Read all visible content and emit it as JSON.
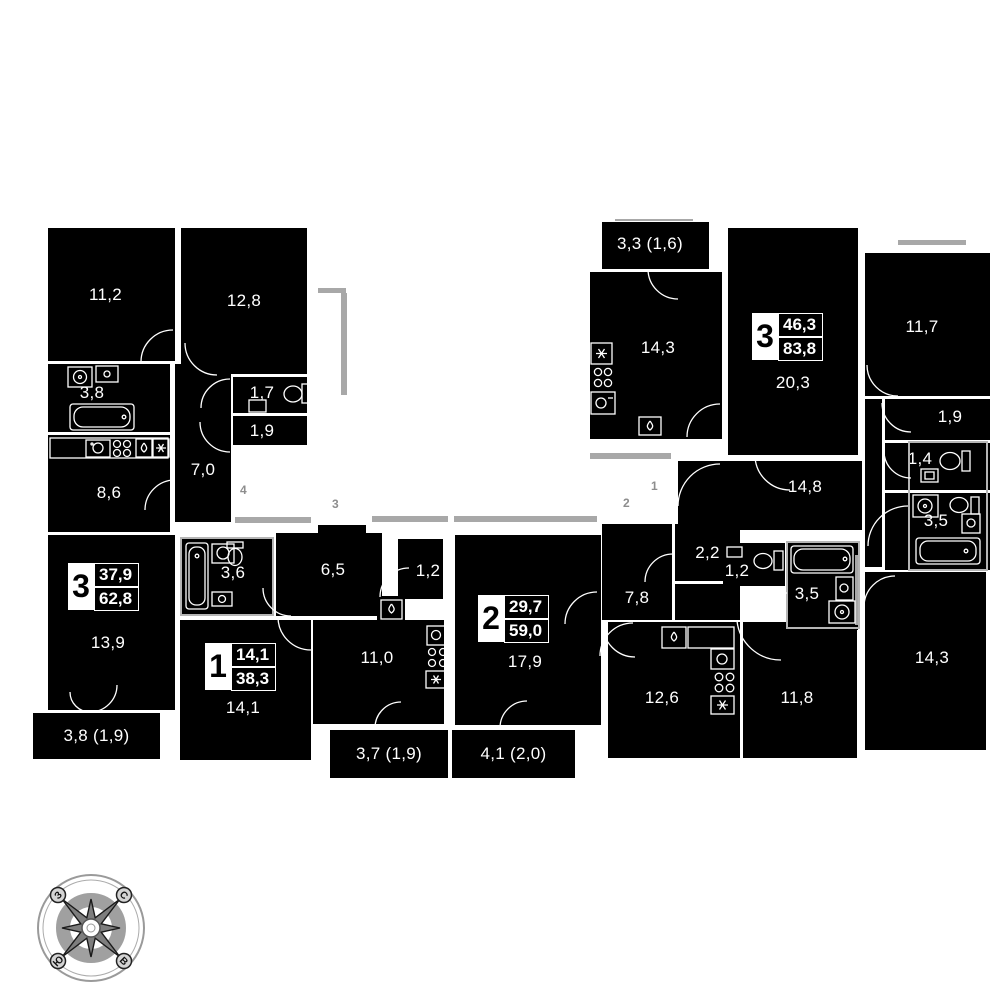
{
  "page": {
    "background": "#ffffff"
  },
  "colors": {
    "room_fill": "#000000",
    "wall": "#ffffff",
    "rail_gray": "#a8a8a8",
    "marker_gray": "#8d8d8d"
  },
  "sections": {
    "apt_left": {
      "badge": {
        "rooms": "3",
        "living_area": "37,9",
        "total_area": "62,8"
      },
      "bedroom1": "11,2",
      "bedroom2": "12,8",
      "bathroom": "3,8",
      "wc": "1,7",
      "hall_small": "1,9",
      "hall": "7,0",
      "kitchen": "8,6",
      "living": "13,9",
      "balcony": "3,8 (1,9)"
    },
    "apt_1": {
      "badge": {
        "rooms": "1",
        "living_area": "14,1",
        "total_area": "38,3"
      },
      "bathroom": "3,6",
      "hall": "6,5",
      "closet": "1,2",
      "kitchen": "11,0",
      "room": "14,1",
      "balcony": "3,7 (1,9)"
    },
    "apt_2": {
      "badge": {
        "rooms": "2",
        "living_area": "29,7",
        "total_area": "59,0"
      },
      "living": "17,9",
      "balcony": "4,1 (2,0)",
      "closet": "2,2",
      "hall": "7,8",
      "wc": "1,2",
      "bathroom": "3,5",
      "kitchen": "12,6",
      "bedroom": "11,8"
    },
    "apt_3": {
      "badge": {
        "rooms": "3",
        "living_area": "46,3",
        "total_area": "83,8"
      },
      "balcony": "3,3 (1,6)",
      "kitchen": "14,3",
      "living": "20,3",
      "corridor": "14,8",
      "bedroom1": "11,7",
      "closet": "1,9",
      "wc": "1,4",
      "bathroom": "3,5",
      "bedroom2": "14,3"
    }
  },
  "corridor_markers": [
    "4",
    "3",
    "2",
    "1"
  ],
  "compass": {
    "north": "С",
    "south": "Ю",
    "west": "З",
    "east": "В"
  }
}
